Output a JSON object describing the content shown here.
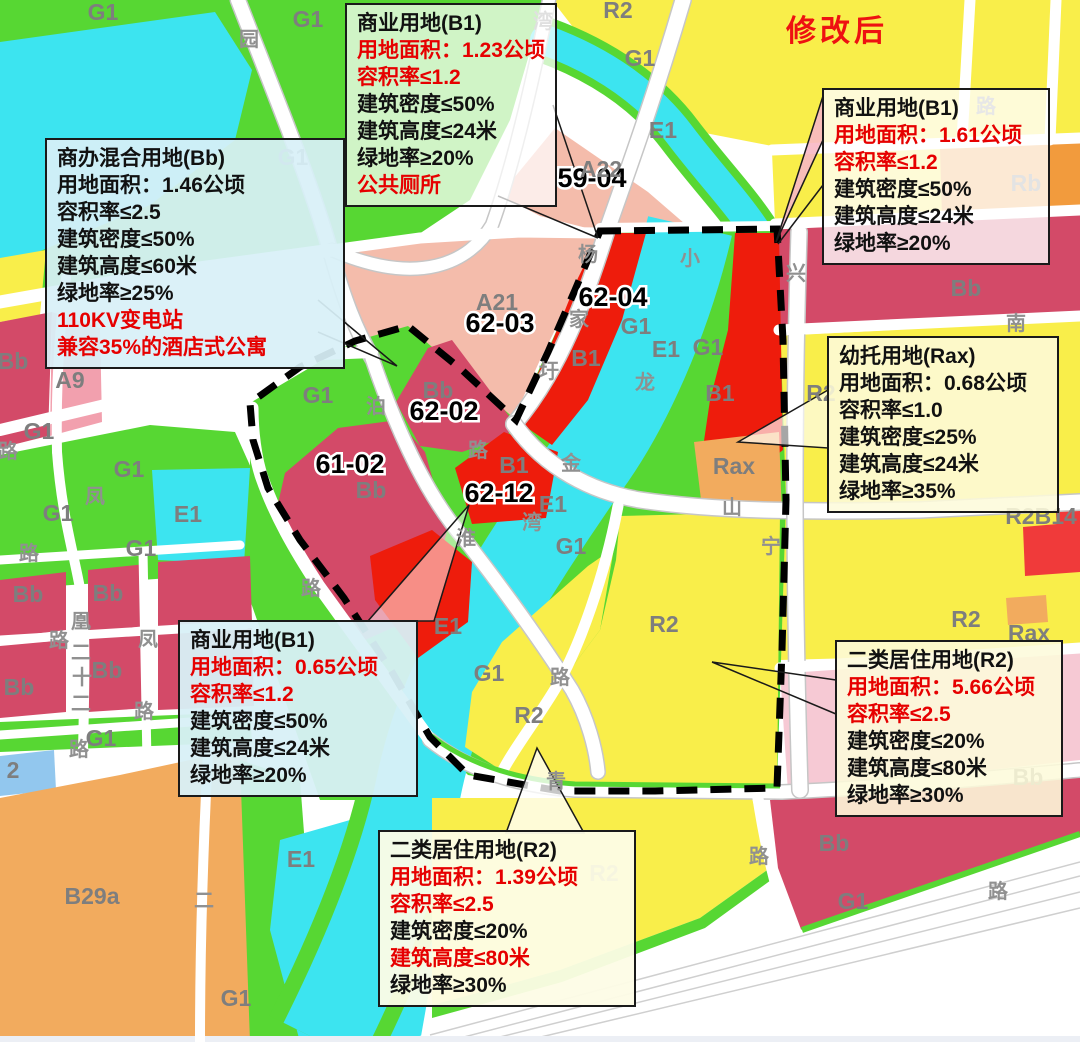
{
  "header": {
    "modified_label": "修改后"
  },
  "colors": {
    "g1_green": "#57d733",
    "e1_cyan": "#3ce4f0",
    "r2_yellow": "#f9ee4a",
    "b1_red": "#ee1c0c",
    "bb_crimson": "#d34a68",
    "a_pink": "#f4bcab",
    "a9_pink": "#f2a0ae",
    "orange": "#f2ab5e",
    "rb_orange": "#f29b3d",
    "pale_pink": "#f6c9d4",
    "blue_parcel": "#92c7ee",
    "red_text": "#e60000"
  },
  "map": {
    "callouts": [
      {
        "name": "callout-bb-mixed",
        "x": 45,
        "y": 138,
        "w": 300,
        "bg": "rgba(216,240,247,0.93)",
        "lines": [
          {
            "t": "商办混合用地(Bb)"
          },
          {
            "t": "用地面积：1.46公顷"
          },
          {
            "t": "容积率≤2.5"
          },
          {
            "t": "建筑密度≤50%"
          },
          {
            "t": "建筑高度≤60米"
          },
          {
            "t": "绿地率≥25%"
          },
          {
            "t": "110KV变电站",
            "red": true
          },
          {
            "t": "兼容35%的酒店式公寓",
            "red": true
          }
        ]
      },
      {
        "name": "callout-b1-123",
        "x": 345,
        "y": 3,
        "w": 210,
        "bg": "rgba(255,255,255,0.72)",
        "lines": [
          {
            "t": "商业用地(B1)"
          },
          {
            "t": "用地面积：1.23公顷",
            "red": true
          },
          {
            "t": "容积率≤1.2",
            "red": true
          },
          {
            "t": "建筑密度≤50%"
          },
          {
            "t": "建筑高度≤24米"
          },
          {
            "t": "绿地率≥20%"
          },
          {
            "t": "公共厕所",
            "red": true
          }
        ]
      },
      {
        "name": "callout-b1-161",
        "x": 822,
        "y": 88,
        "w": 228,
        "bg": "rgba(255,255,255,0.78)",
        "lines": [
          {
            "t": "商业用地(B1)"
          },
          {
            "t": "用地面积：1.61公顷",
            "red": true
          },
          {
            "t": "容积率≤1.2",
            "red": true
          },
          {
            "t": "建筑密度≤50%"
          },
          {
            "t": "建筑高度≤24米"
          },
          {
            "t": "绿地率≥20%"
          }
        ]
      },
      {
        "name": "callout-rax",
        "x": 827,
        "y": 336,
        "w": 232,
        "bg": "rgba(253,250,219,0.88)",
        "lines": [
          {
            "t": "幼托用地(Rax)"
          },
          {
            "t": "用地面积：0.68公顷"
          },
          {
            "t": "容积率≤1.0"
          },
          {
            "t": "建筑密度≤25%"
          },
          {
            "t": "建筑高度≤24米"
          },
          {
            "t": "绿地率≥35%"
          }
        ]
      },
      {
        "name": "callout-b1-065",
        "x": 178,
        "y": 620,
        "w": 240,
        "bg": "rgba(216,240,247,0.95)",
        "lines": [
          {
            "t": "商业用地(B1)"
          },
          {
            "t": "用地面积：0.65公顷",
            "red": true
          },
          {
            "t": "容积率≤1.2",
            "red": true
          },
          {
            "t": "建筑密度≤50%"
          },
          {
            "t": "建筑高度≤24米"
          },
          {
            "t": "绿地率≥20%"
          }
        ]
      },
      {
        "name": "callout-r2-566",
        "x": 835,
        "y": 640,
        "w": 228,
        "bg": "rgba(253,250,219,0.88)",
        "lines": [
          {
            "t": "二类居住用地(R2)"
          },
          {
            "t": "用地面积：5.66公顷",
            "red": true
          },
          {
            "t": "容积率≤2.5",
            "red": true
          },
          {
            "t": "建筑密度≤20%"
          },
          {
            "t": "建筑高度≤80米"
          },
          {
            "t": "绿地率≥30%"
          }
        ]
      },
      {
        "name": "callout-r2-139",
        "x": 378,
        "y": 830,
        "w": 258,
        "bg": "rgba(253,252,230,0.95)",
        "lines": [
          {
            "t": "二类居住用地(R2)"
          },
          {
            "t": "用地面积：1.39公顷",
            "red": true
          },
          {
            "t": "容积率≤2.5",
            "red": true
          },
          {
            "t": "建筑密度≤20%"
          },
          {
            "t": "建筑高度≤80米",
            "red": true
          },
          {
            "t": "绿地率≥30%"
          }
        ]
      }
    ],
    "labels": [
      [
        "59-04",
        592,
        178,
        "plot"
      ],
      [
        "62-04",
        613,
        297,
        "plot"
      ],
      [
        "62-03",
        500,
        323,
        "plot"
      ],
      [
        "62-02",
        444,
        411,
        "plot"
      ],
      [
        "61-02",
        350,
        464,
        "plot"
      ],
      [
        "62-12",
        499,
        493,
        "plot"
      ],
      [
        "G1",
        103,
        12,
        "zone"
      ],
      [
        "G1",
        308,
        19,
        "zone"
      ],
      [
        "R2",
        618,
        10,
        "zone"
      ],
      [
        "G1",
        640,
        58,
        "zone"
      ],
      [
        "E1",
        663,
        130,
        "zone"
      ],
      [
        "A22",
        601,
        169,
        "zone"
      ],
      [
        "G1",
        293,
        157,
        "zone"
      ],
      [
        "A21",
        497,
        302,
        "zone"
      ],
      [
        "G1",
        318,
        395,
        "zone"
      ],
      [
        "Bb",
        438,
        390,
        "zone"
      ],
      [
        "Bb",
        371,
        490,
        "zone"
      ],
      [
        "B1",
        514,
        465,
        "zone"
      ],
      [
        "B1",
        586,
        358,
        "zone"
      ],
      [
        "G1",
        636,
        326,
        "zone"
      ],
      [
        "E1",
        666,
        349,
        "zone"
      ],
      [
        "G1",
        708,
        347,
        "zone"
      ],
      [
        "B1",
        720,
        393,
        "zone"
      ],
      [
        "Rax",
        734,
        466,
        "zone"
      ],
      [
        "G1",
        571,
        546,
        "zone"
      ],
      [
        "E1",
        553,
        504,
        "zone"
      ],
      [
        "E1",
        448,
        626,
        "zone"
      ],
      [
        "G1",
        489,
        673,
        "zone"
      ],
      [
        "R2",
        529,
        715,
        "zone"
      ],
      [
        "R2",
        664,
        624,
        "zone"
      ],
      [
        "E1",
        301,
        859,
        "zone"
      ],
      [
        "G1",
        236,
        998,
        "zone"
      ],
      [
        "Bb",
        13,
        361,
        "zone"
      ],
      [
        "A9",
        70,
        380,
        "zone"
      ],
      [
        "G1",
        39,
        431,
        "zone"
      ],
      [
        "G1",
        129,
        469,
        "zone"
      ],
      [
        "E1",
        188,
        514,
        "zone"
      ],
      [
        "G1",
        58,
        513,
        "zone"
      ],
      [
        "G1",
        141,
        548,
        "zone"
      ],
      [
        "Bb",
        28,
        594,
        "zone"
      ],
      [
        "Bb",
        108,
        593,
        "zone"
      ],
      [
        "Bb",
        19,
        687,
        "zone"
      ],
      [
        "Bb",
        107,
        670,
        "zone"
      ],
      [
        "2",
        13,
        770,
        "zone"
      ],
      [
        "B29a",
        92,
        896,
        "zone"
      ],
      [
        "G1",
        101,
        738,
        "zone"
      ],
      [
        "Bb",
        966,
        288,
        "zone"
      ],
      [
        "Rb",
        1026,
        183,
        "zone"
      ],
      [
        "R2",
        821,
        393,
        "zone"
      ],
      [
        "R2B14",
        1041,
        516,
        "zone"
      ],
      [
        "R2",
        966,
        619,
        "zone"
      ],
      [
        "Rax",
        1029,
        633,
        "zone"
      ],
      [
        "Bb",
        1028,
        777,
        "zone"
      ],
      [
        "Bb",
        834,
        843,
        "zone"
      ],
      [
        "G1",
        853,
        901,
        "zone"
      ],
      [
        "R2",
        604,
        873,
        "zone"
      ],
      [
        "湾",
        543,
        22,
        "road"
      ],
      [
        "园",
        249,
        40,
        "road"
      ],
      [
        "路",
        986,
        107,
        "road"
      ],
      [
        "杨",
        588,
        255,
        "road"
      ],
      [
        "家",
        579,
        320,
        "road"
      ],
      [
        "圩",
        549,
        372,
        "road"
      ],
      [
        "泊",
        376,
        407,
        "road"
      ],
      [
        "路",
        478,
        451,
        "road"
      ],
      [
        "淮",
        466,
        539,
        "road"
      ],
      [
        "小",
        690,
        259,
        "road"
      ],
      [
        "龙",
        645,
        383,
        "road"
      ],
      [
        "湾",
        532,
        523,
        "road"
      ],
      [
        "金",
        571,
        464,
        "road"
      ],
      [
        "山",
        732,
        508,
        "road"
      ],
      [
        "兴",
        796,
        274,
        "road"
      ],
      [
        "宁",
        771,
        547,
        "road"
      ],
      [
        "南",
        1016,
        324,
        "road"
      ],
      [
        "路",
        560,
        678,
        "road"
      ],
      [
        "青",
        556,
        782,
        "road"
      ],
      [
        "路",
        311,
        589,
        "road"
      ],
      [
        "路",
        8,
        452,
        "road"
      ],
      [
        "路",
        29,
        554,
        "road"
      ],
      [
        "凤",
        95,
        497,
        "road"
      ],
      [
        "凤",
        148,
        640,
        "road"
      ],
      [
        "凰",
        81,
        622,
        "road"
      ],
      [
        "路",
        59,
        641,
        "road"
      ],
      [
        "二",
        81,
        653,
        "road"
      ],
      [
        "十",
        82,
        678,
        "road"
      ],
      [
        "二",
        81,
        704,
        "road"
      ],
      [
        "路",
        79,
        750,
        "road"
      ],
      [
        "路",
        144,
        712,
        "road"
      ],
      [
        "二",
        204,
        901,
        "road"
      ],
      [
        "路",
        759,
        857,
        "road"
      ],
      [
        "路",
        998,
        892,
        "road"
      ]
    ]
  }
}
